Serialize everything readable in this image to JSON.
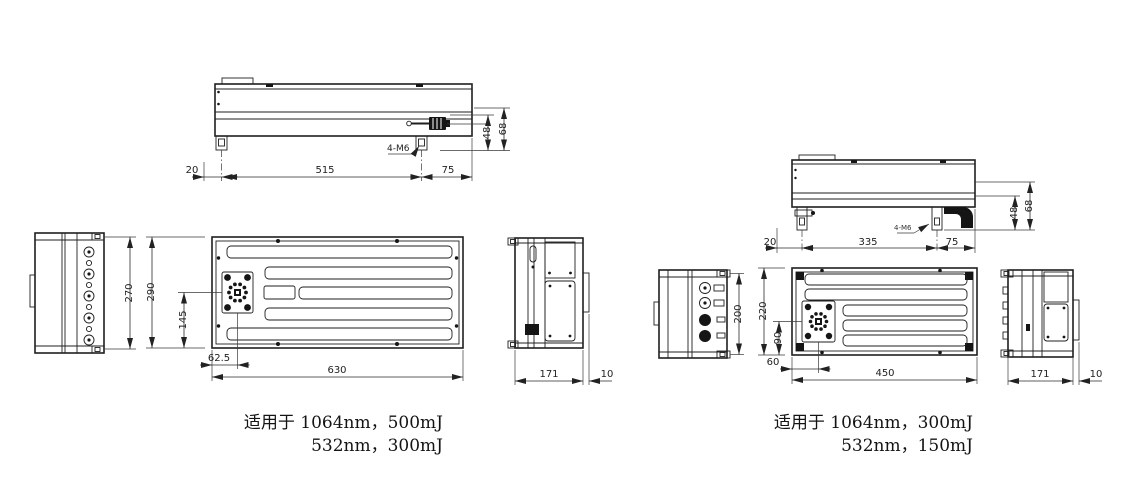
{
  "colors": {
    "line": "#1f1f1f",
    "background": "#ffffff"
  },
  "units": {
    "left": {
      "side": {
        "offset": "20",
        "span": "515",
        "tail": "75",
        "height1": "48",
        "height2": "68",
        "thread": "4-M6"
      },
      "front": {
        "height": "270"
      },
      "plan": {
        "height": "290",
        "port_y": "145",
        "port_x": "62.5",
        "width": "630"
      },
      "end": {
        "depth": "171",
        "lid": "10"
      },
      "caption": {
        "line1": "适用于 1064nm，500mJ",
        "line2": "532nm，300mJ"
      }
    },
    "right": {
      "side": {
        "offset": "20",
        "span": "335",
        "tail": "75",
        "height1": "48",
        "height2": "68",
        "thread": "4-M6"
      },
      "front": {
        "height": "200"
      },
      "plan": {
        "height": "220",
        "port_y": "90",
        "port_x": "60",
        "width": "450"
      },
      "end": {
        "depth": "171",
        "lid": "10"
      },
      "caption": {
        "line1": "适用于 1064nm，300mJ",
        "line2": "532nm，150mJ"
      }
    }
  }
}
